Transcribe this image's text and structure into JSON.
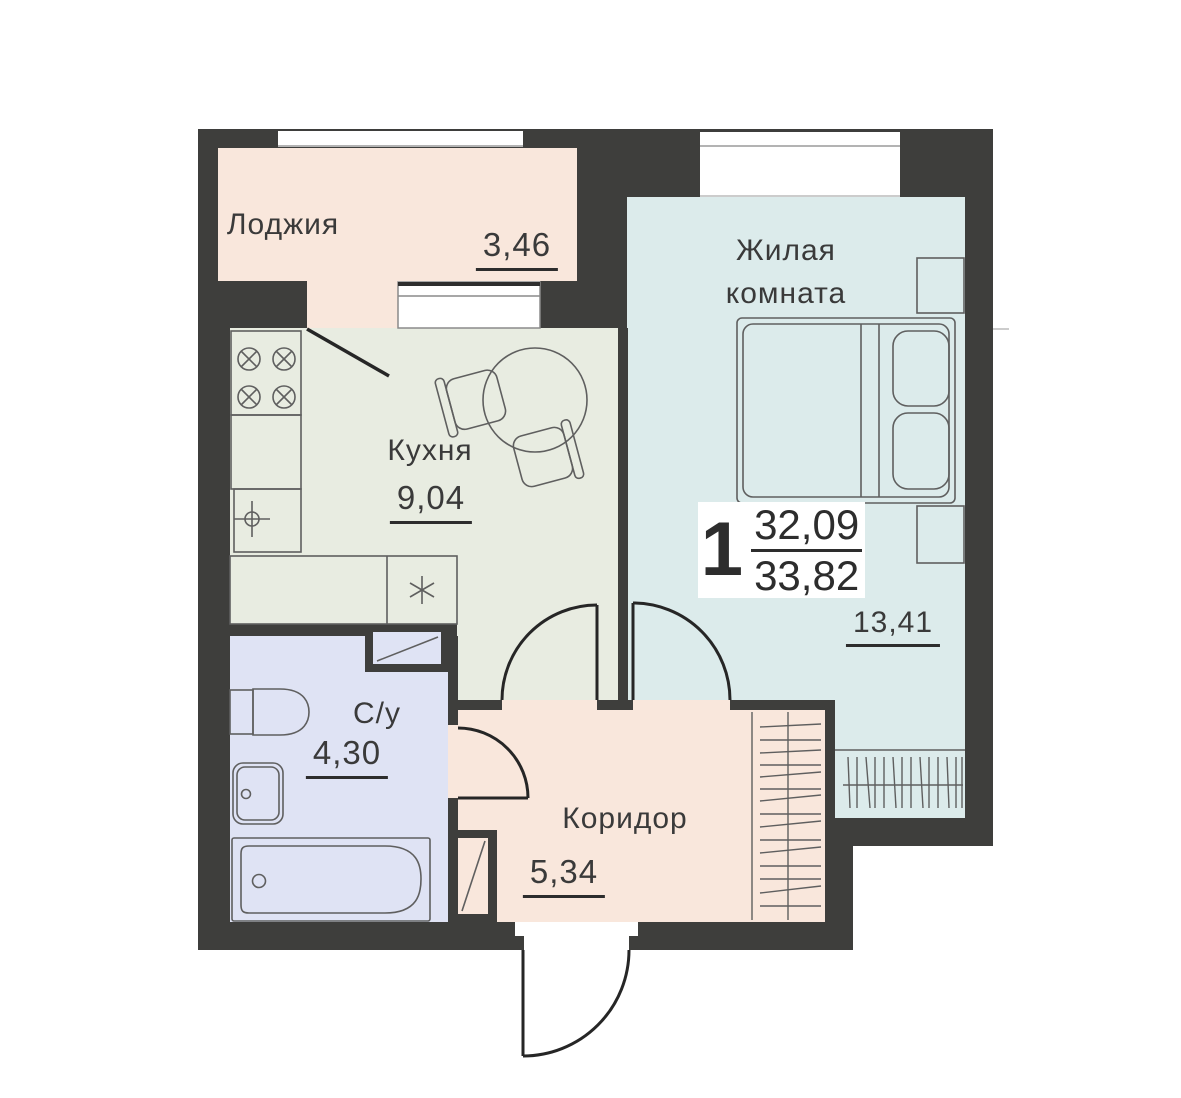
{
  "theme": {
    "background": "#ffffff",
    "wall": "#3e3e3c",
    "loggia": "#f9e7dc",
    "kitchen": "#e8ece1",
    "living": "#dcebeb",
    "bathroom": "#dfe3f4",
    "corridor": "#f9e7dc",
    "outline": "#5f5f5f",
    "door": "#262626",
    "text": "#3a3a3a",
    "window_line": "#9a9a9a"
  },
  "badge": {
    "rooms_count": "1",
    "living_area": "32,09",
    "total_area": "33,82"
  },
  "rooms": [
    {
      "name": "Лоджия",
      "area": "3,46"
    },
    {
      "name": "Кухня",
      "area": "9,04"
    },
    {
      "name": "Жилая\nкомната",
      "area": "13,41"
    },
    {
      "name": "С/у",
      "area": "4,30"
    },
    {
      "name": "Коридор",
      "area": "5,34"
    }
  ]
}
